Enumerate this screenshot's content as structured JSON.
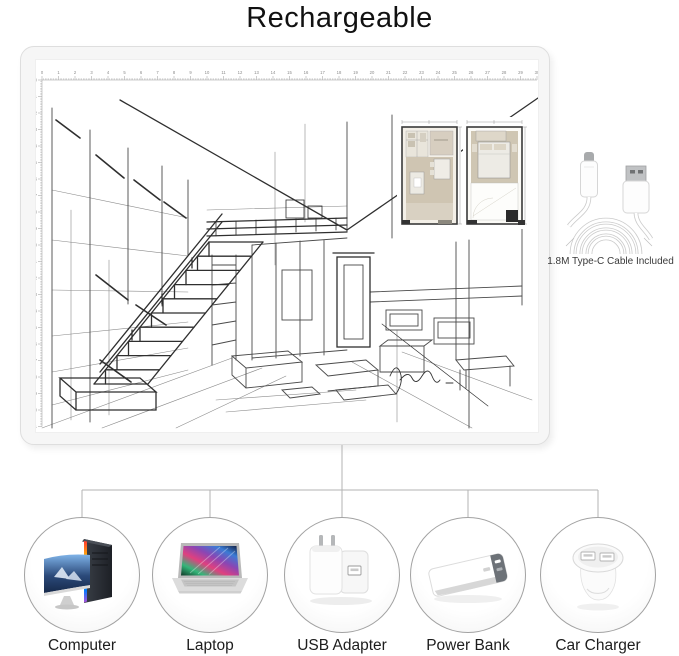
{
  "title": "Rechargeable",
  "pad": {
    "name": "LED light pad with tracing sketch",
    "ruler": {
      "top_min": 0,
      "top_max": 30,
      "left_min": 0,
      "left_max": 21,
      "origin_x": 6,
      "origin_y": 20,
      "step": 16.5,
      "color": "#9a9a9a"
    }
  },
  "cable": {
    "caption": "1.8M Type-C Cable Included",
    "connectors": [
      "usb-type-c",
      "usb-a"
    ]
  },
  "charging_options": [
    {
      "label": "Computer",
      "icon": "desktop-computer-icon"
    },
    {
      "label": "Laptop",
      "icon": "laptop-icon"
    },
    {
      "label": "USB Adapter",
      "icon": "usb-wall-adapter-icon"
    },
    {
      "label": "Power Bank",
      "icon": "power-bank-icon"
    },
    {
      "label": "Car Charger",
      "icon": "car-charger-icon"
    }
  ],
  "colors": {
    "connector_line": "#b3b3b3",
    "circle_border": "#a2a2a2",
    "sketch_ink": "#2f2f2f",
    "pad_bezel": "#f6f6f6",
    "plan_beige": "#cfc5b2",
    "plan_wall": "#3a3a3a"
  }
}
